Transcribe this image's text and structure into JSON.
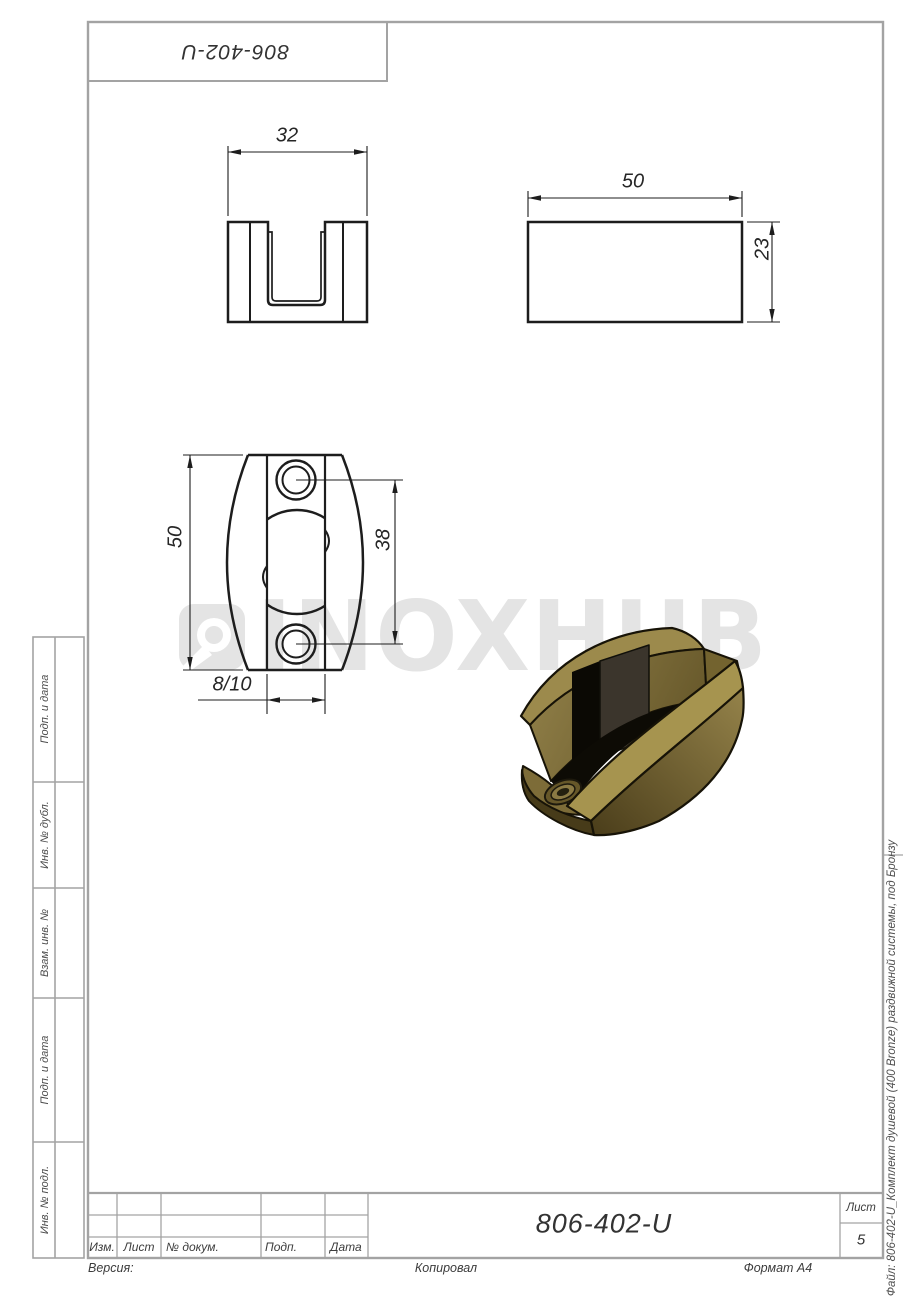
{
  "top_stamp": {
    "designation": "806-402-U"
  },
  "dimensions": {
    "front_width": "32",
    "side_length": "50",
    "side_height": "23",
    "top_length": "50",
    "hole_spacing": "38",
    "slot_width": "8/10"
  },
  "watermark": {
    "text": "INOXHUB"
  },
  "sidebar": {
    "labels": [
      "Подп. и дата",
      "Инв. № дубл.",
      "Взам. инв. №",
      "Подп. и дата",
      "Инв. № подл."
    ]
  },
  "title_block": {
    "designation": "806-402-U",
    "col_izm": "Изм.",
    "col_list": "Лист",
    "col_docnum": "№ докум.",
    "col_podp": "Подп.",
    "col_data": "Дата",
    "sheet_label": "Лист",
    "sheet_number": "5"
  },
  "footer": {
    "version": "Версия:",
    "copied": "Копировал",
    "format": "Формат А4"
  },
  "margin_note": {
    "file": "Файл: 806-402-U_Комплект душевой (400 Bronze) раздвижной системы, под Бронзу"
  },
  "colors": {
    "line_dark": "#1d1d1d",
    "line_gray": "#a3a3a3",
    "watermark_gray": "#e4e4e4",
    "bronze_light": "#a6944f",
    "bronze_mid": "#8a7942",
    "bronze_dark": "#4a3d1a"
  }
}
